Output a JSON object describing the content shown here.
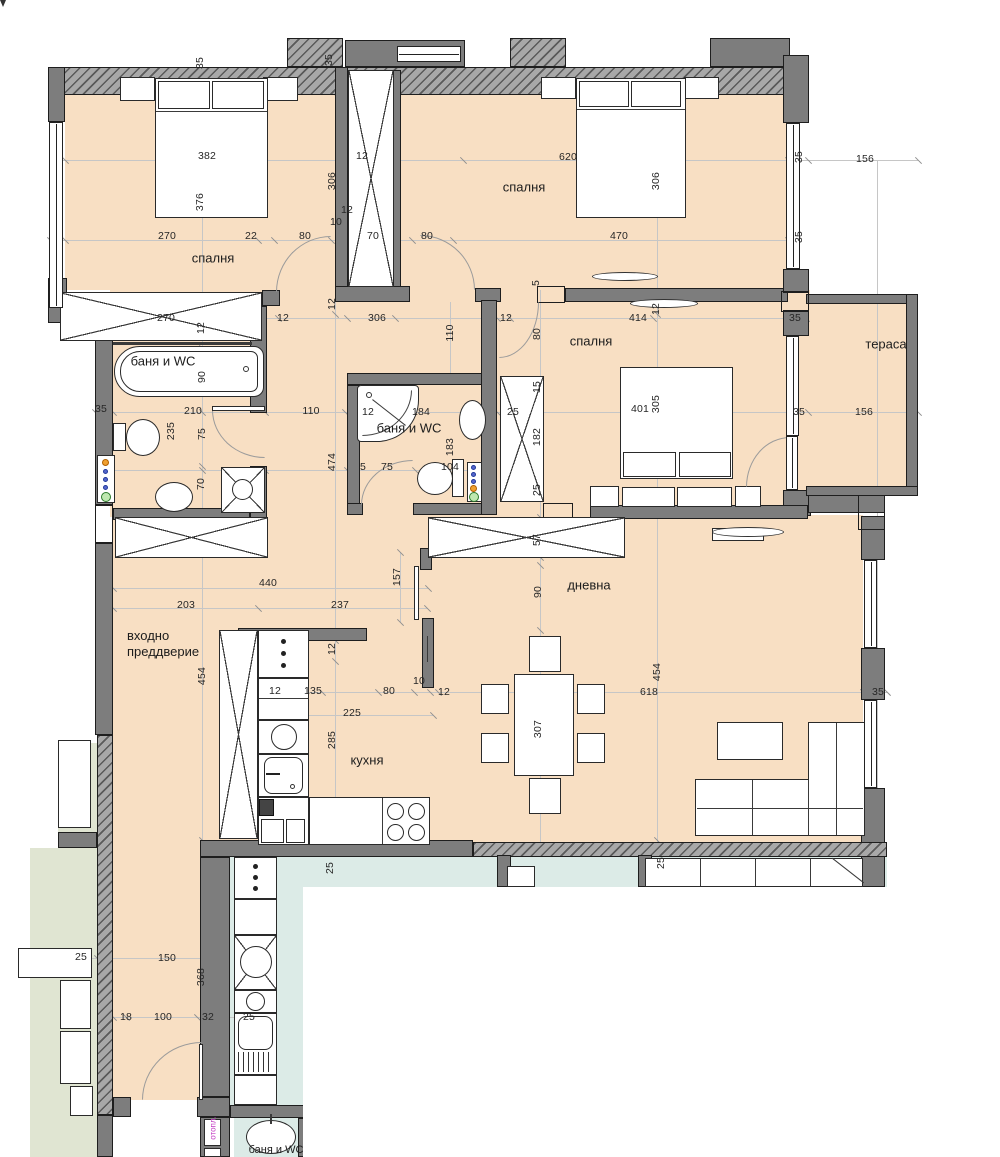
{
  "drawing": {
    "type": "apartment-floor-plan",
    "language": "Bulgarian",
    "colors": {
      "floor": "#f8dfc3",
      "neighbor_teal": "#dcebe7",
      "neighbor_green": "#e0e5d2",
      "wall_gray": "#7d7d7d",
      "wall_outline": "#1e1e1e",
      "dim_text": "#262626",
      "heating_label": "#c238c2",
      "dim_line": "#c6c6c6"
    }
  },
  "rooms": [
    {
      "id": "bedroom-1",
      "label": "спалня",
      "x": 213,
      "y": 258
    },
    {
      "id": "bedroom-2",
      "label": "спалня",
      "x": 524,
      "y": 187
    },
    {
      "id": "bedroom-3",
      "label": "спалня",
      "x": 591,
      "y": 341
    },
    {
      "id": "bath-1",
      "label": "баня и WC",
      "x": 163,
      "y": 361
    },
    {
      "id": "bath-2",
      "label": "баня и WC",
      "x": 409,
      "y": 428
    },
    {
      "id": "terrace",
      "label": "тераса",
      "x": 886,
      "y": 344
    },
    {
      "id": "living-room",
      "label": "дневна",
      "x": 589,
      "y": 585
    },
    {
      "id": "kitchen",
      "label": "кухня",
      "x": 367,
      "y": 760
    },
    {
      "id": "entry-hall",
      "label": "входно преддверие",
      "x": 127,
      "y": 628,
      "w": 92
    },
    {
      "id": "heating-riser",
      "label": "отопл.",
      "x": 213,
      "y": 1128,
      "v": true,
      "s": 8,
      "c": "#c238c2"
    },
    {
      "id": "neighbor-bath",
      "label": "баня и WC",
      "x": 276,
      "y": 1150,
      "s": 11
    }
  ],
  "dims": [
    {
      "t": "35",
      "x": 200,
      "y": 63,
      "v": true
    },
    {
      "t": "35",
      "x": 329,
      "y": 60,
      "v": true
    },
    {
      "t": "382",
      "x": 207,
      "y": 156
    },
    {
      "t": "376",
      "x": 200,
      "y": 202,
      "v": true
    },
    {
      "t": "306",
      "x": 332,
      "y": 181,
      "v": true
    },
    {
      "t": "12",
      "x": 362,
      "y": 156
    },
    {
      "t": "270",
      "x": 167,
      "y": 236
    },
    {
      "t": "22",
      "x": 251,
      "y": 236
    },
    {
      "t": "80",
      "x": 305,
      "y": 236
    },
    {
      "t": "70",
      "x": 373,
      "y": 236
    },
    {
      "t": "80",
      "x": 427,
      "y": 236
    },
    {
      "t": "620",
      "x": 568,
      "y": 157
    },
    {
      "t": "306",
      "x": 656,
      "y": 181,
      "v": true
    },
    {
      "t": "470",
      "x": 619,
      "y": 236
    },
    {
      "t": "35",
      "x": 799,
      "y": 157,
      "v": true
    },
    {
      "t": "35",
      "x": 799,
      "y": 237,
      "v": true
    },
    {
      "t": "156",
      "x": 865,
      "y": 159
    },
    {
      "t": "10",
      "x": 336,
      "y": 222
    },
    {
      "t": "12",
      "x": 347,
      "y": 210
    },
    {
      "t": "270",
      "x": 166,
      "y": 318
    },
    {
      "t": "12",
      "x": 201,
      "y": 328,
      "v": true
    },
    {
      "t": "12",
      "x": 283,
      "y": 318
    },
    {
      "t": "12",
      "x": 332,
      "y": 304,
      "v": true
    },
    {
      "t": "306",
      "x": 377,
      "y": 318
    },
    {
      "t": "110",
      "x": 450,
      "y": 333,
      "v": true
    },
    {
      "t": "12",
      "x": 506,
      "y": 318
    },
    {
      "t": "80",
      "x": 537,
      "y": 334,
      "v": true
    },
    {
      "t": "414",
      "x": 638,
      "y": 318
    },
    {
      "t": "12",
      "x": 656,
      "y": 309,
      "v": true
    },
    {
      "t": "35",
      "x": 795,
      "y": 318
    },
    {
      "t": "5",
      "x": 536,
      "y": 283,
      "v": true
    },
    {
      "t": "90",
      "x": 202,
      "y": 377,
      "v": true
    },
    {
      "t": "210",
      "x": 193,
      "y": 411
    },
    {
      "t": "110",
      "x": 311,
      "y": 411
    },
    {
      "t": "235",
      "x": 171,
      "y": 431,
      "v": true
    },
    {
      "t": "75",
      "x": 202,
      "y": 434,
      "v": true
    },
    {
      "t": "70",
      "x": 201,
      "y": 484,
      "v": true
    },
    {
      "t": "474",
      "x": 332,
      "y": 462,
      "v": true
    },
    {
      "t": "35",
      "x": 101,
      "y": 409
    },
    {
      "t": "12",
      "x": 368,
      "y": 412
    },
    {
      "t": "184",
      "x": 421,
      "y": 412
    },
    {
      "t": "183",
      "x": 450,
      "y": 447,
      "v": true
    },
    {
      "t": "104",
      "x": 450,
      "y": 467
    },
    {
      "t": "75",
      "x": 387,
      "y": 467
    },
    {
      "t": "5",
      "x": 363,
      "y": 467
    },
    {
      "t": "25",
      "x": 513,
      "y": 412
    },
    {
      "t": "15",
      "x": 537,
      "y": 387,
      "v": true
    },
    {
      "t": "182",
      "x": 537,
      "y": 437,
      "v": true
    },
    {
      "t": "25",
      "x": 537,
      "y": 490,
      "v": true
    },
    {
      "t": "401",
      "x": 640,
      "y": 409
    },
    {
      "t": "305",
      "x": 656,
      "y": 404,
      "v": true
    },
    {
      "t": "156",
      "x": 864,
      "y": 412
    },
    {
      "t": "35",
      "x": 799,
      "y": 412
    },
    {
      "t": "440",
      "x": 268,
      "y": 583
    },
    {
      "t": "203",
      "x": 186,
      "y": 605
    },
    {
      "t": "237",
      "x": 340,
      "y": 605
    },
    {
      "t": "157",
      "x": 397,
      "y": 577,
      "v": true
    },
    {
      "t": "454",
      "x": 202,
      "y": 676,
      "v": true
    },
    {
      "t": "90",
      "x": 538,
      "y": 592,
      "v": true
    },
    {
      "t": "57",
      "x": 537,
      "y": 540,
      "v": true
    },
    {
      "t": "454",
      "x": 657,
      "y": 672,
      "v": true
    },
    {
      "t": "618",
      "x": 649,
      "y": 692
    },
    {
      "t": "12",
      "x": 444,
      "y": 692
    },
    {
      "t": "307",
      "x": 538,
      "y": 729,
      "v": true
    },
    {
      "t": "35",
      "x": 878,
      "y": 692
    },
    {
      "t": "225",
      "x": 352,
      "y": 713
    },
    {
      "t": "285",
      "x": 332,
      "y": 740,
      "v": true
    },
    {
      "t": "135",
      "x": 313,
      "y": 691
    },
    {
      "t": "12",
      "x": 275,
      "y": 691
    },
    {
      "t": "80",
      "x": 389,
      "y": 691
    },
    {
      "t": "10",
      "x": 419,
      "y": 681
    },
    {
      "t": "12",
      "x": 332,
      "y": 649,
      "v": true
    },
    {
      "t": "150",
      "x": 167,
      "y": 958
    },
    {
      "t": "368",
      "x": 201,
      "y": 977,
      "v": true
    },
    {
      "t": "18",
      "x": 126,
      "y": 1017
    },
    {
      "t": "100",
      "x": 163,
      "y": 1017
    },
    {
      "t": "32",
      "x": 208,
      "y": 1017
    },
    {
      "t": "25",
      "x": 249,
      "y": 1017
    },
    {
      "t": "25",
      "x": 330,
      "y": 868,
      "v": true
    },
    {
      "t": "25",
      "x": 661,
      "y": 863,
      "v": true
    },
    {
      "t": "25",
      "x": 81,
      "y": 957
    }
  ],
  "ticks": [
    [
      65,
      160
    ],
    [
      345,
      160
    ],
    [
      395,
      160
    ],
    [
      463,
      160
    ],
    [
      788,
      160
    ],
    [
      808,
      160
    ],
    [
      918,
      160
    ],
    [
      50,
      240
    ],
    [
      65,
      240
    ],
    [
      258,
      240
    ],
    [
      274,
      240
    ],
    [
      331,
      240
    ],
    [
      345,
      240
    ],
    [
      412,
      240
    ],
    [
      453,
      240
    ],
    [
      788,
      240
    ],
    [
      95,
      318
    ],
    [
      113,
      318
    ],
    [
      193,
      318
    ],
    [
      263,
      318
    ],
    [
      278,
      318
    ],
    [
      347,
      318
    ],
    [
      395,
      318
    ],
    [
      497,
      318
    ],
    [
      510,
      318
    ],
    [
      653,
      318
    ],
    [
      806,
      318
    ],
    [
      95,
      412
    ],
    [
      113,
      412
    ],
    [
      265,
      412
    ],
    [
      345,
      412
    ],
    [
      355,
      412
    ],
    [
      487,
      412
    ],
    [
      497,
      412
    ],
    [
      808,
      412
    ],
    [
      918,
      412
    ],
    [
      98,
      470
    ],
    [
      202,
      470
    ],
    [
      265,
      470
    ],
    [
      347,
      470
    ],
    [
      415,
      470
    ],
    [
      483,
      470
    ],
    [
      113,
      588
    ],
    [
      428,
      588
    ],
    [
      113,
      608
    ],
    [
      258,
      608
    ],
    [
      427,
      608
    ],
    [
      230,
      692
    ],
    [
      266,
      692
    ],
    [
      304,
      692
    ],
    [
      322,
      692
    ],
    [
      378,
      692
    ],
    [
      414,
      692
    ],
    [
      430,
      692
    ],
    [
      438,
      692
    ],
    [
      863,
      692
    ],
    [
      887,
      692
    ],
    [
      272,
      715
    ],
    [
      433,
      715
    ],
    [
      113,
      1017
    ],
    [
      126,
      1017
    ],
    [
      197,
      1017
    ],
    [
      220,
      1017
    ],
    [
      240,
      1017
    ],
    [
      261,
      1017
    ],
    [
      60,
      958
    ],
    [
      97,
      958
    ],
    [
      204,
      958
    ],
    [
      202,
      348
    ],
    [
      202,
      412
    ],
    [
      202,
      466
    ],
    [
      202,
      516
    ],
    [
      202,
      840
    ],
    [
      335,
      95
    ],
    [
      335,
      314
    ],
    [
      335,
      640
    ],
    [
      335,
      661
    ],
    [
      335,
      845
    ],
    [
      540,
      517
    ],
    [
      540,
      557
    ],
    [
      540,
      565
    ],
    [
      540,
      630
    ],
    [
      540,
      845
    ],
    [
      657,
      95
    ],
    [
      657,
      314
    ],
    [
      657,
      515
    ],
    [
      657,
      840
    ],
    [
      400,
      552
    ],
    [
      400,
      622
    ],
    [
      877,
      648
    ],
    [
      877,
      788
    ]
  ]
}
